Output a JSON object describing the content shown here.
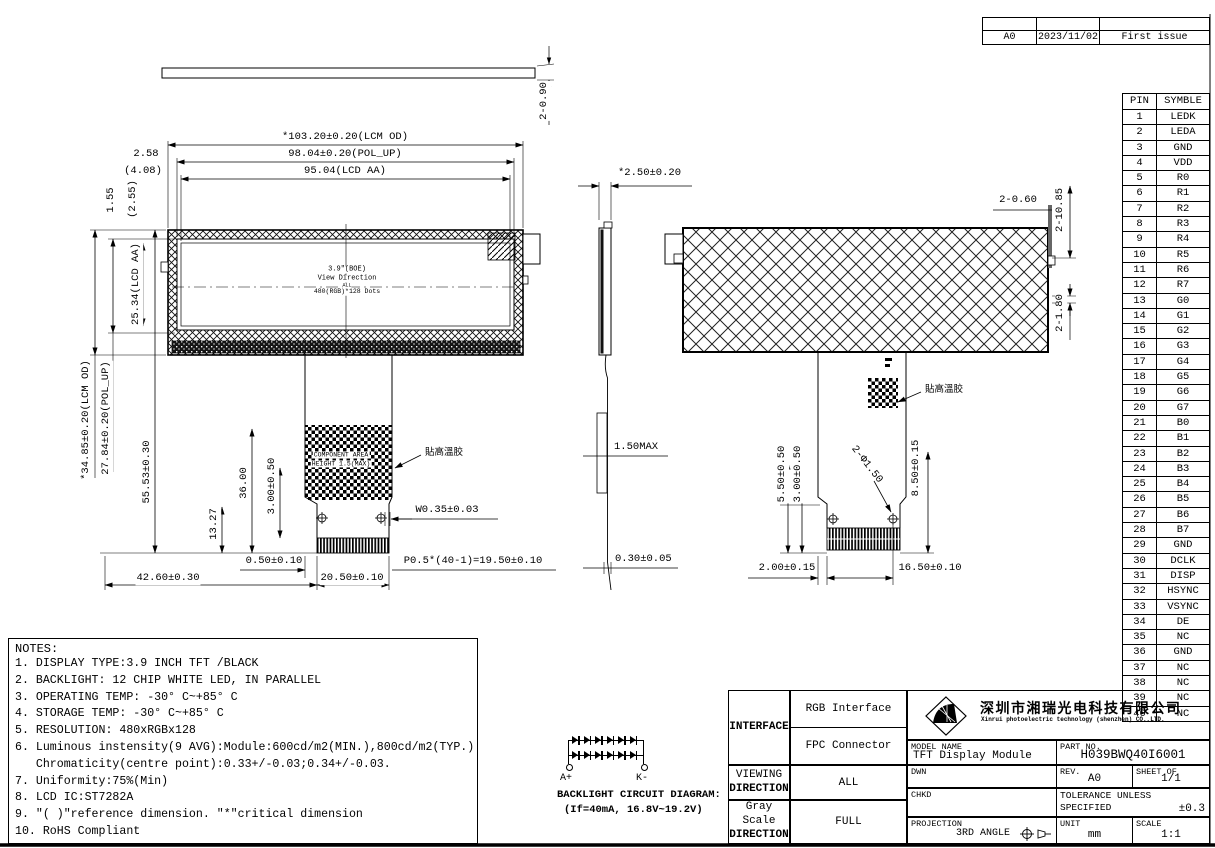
{
  "revision_table": {
    "rev": "A0",
    "date": "2023/11/02",
    "description": "First issue"
  },
  "pin_table": {
    "headers": [
      "PIN",
      "SYMBLE"
    ],
    "rows": [
      [
        "1",
        "LEDK"
      ],
      [
        "2",
        "LEDA"
      ],
      [
        "3",
        "GND"
      ],
      [
        "4",
        "VDD"
      ],
      [
        "5",
        "R0"
      ],
      [
        "6",
        "R1"
      ],
      [
        "7",
        "R2"
      ],
      [
        "8",
        "R3"
      ],
      [
        "9",
        "R4"
      ],
      [
        "10",
        "R5"
      ],
      [
        "11",
        "R6"
      ],
      [
        "12",
        "R7"
      ],
      [
        "13",
        "G0"
      ],
      [
        "14",
        "G1"
      ],
      [
        "15",
        "G2"
      ],
      [
        "16",
        "G3"
      ],
      [
        "17",
        "G4"
      ],
      [
        "18",
        "G5"
      ],
      [
        "19",
        "G6"
      ],
      [
        "20",
        "G7"
      ],
      [
        "21",
        "B0"
      ],
      [
        "22",
        "B1"
      ],
      [
        "23",
        "B2"
      ],
      [
        "24",
        "B3"
      ],
      [
        "25",
        "B4"
      ],
      [
        "26",
        "B5"
      ],
      [
        "27",
        "B6"
      ],
      [
        "28",
        "B7"
      ],
      [
        "29",
        "GND"
      ],
      [
        "30",
        "DCLK"
      ],
      [
        "31",
        "DISP"
      ],
      [
        "32",
        "HSYNC"
      ],
      [
        "33",
        "VSYNC"
      ],
      [
        "34",
        "DE"
      ],
      [
        "35",
        "NC"
      ],
      [
        "36",
        "GND"
      ],
      [
        "37",
        "NC"
      ],
      [
        "38",
        "NC"
      ],
      [
        "39",
        "NC"
      ],
      [
        "40",
        "NC"
      ]
    ]
  },
  "notes": {
    "title": "NOTES:",
    "lines": [
      "1. DISPLAY TYPE:3.9 INCH TFT /BLACK",
      "2. BACKLIGHT: 12 CHIP WHITE LED, IN PARALLEL",
      "3. OPERATING TEMP: -30° C~+85° C",
      "4. STORAGE TEMP: -30° C~+85° C",
      "5. RESOLUTION: 480xRGBx128",
      "6. Luminous instensity(9 AVG):Module:600cd/m2(MIN.),800cd/m2(TYP.)",
      "   Chromaticity(centre point):0.33+/-0.03;0.34+/-0.03.",
      "7. Uniformity:75%(Min)",
      "8. LCD IC:ST7282A",
      "9. ″( )″reference dimension. ″*″critical dimension",
      "10. RoHS Compliant"
    ]
  },
  "dims": {
    "front": {
      "top_thickness": "2-0.90",
      "lcm_od_w": "*103.20±0.20(LCM OD)",
      "pol_w": "98.04±0.20(POL_UP)",
      "aa_w": "95.04(LCD AA)",
      "m258": "2.58",
      "m408": "(4.08)",
      "m155": "1.55",
      "m255": "(2.55)",
      "aa_h": "25.34(LCD AA)",
      "lcm_od_h": "*34.85±0.20(LCM OD)",
      "pol_h": "27.84±0.20(POL_UP)",
      "m5553": "55.53±0.30",
      "m36": "36.00",
      "m300": "3.00±0.50",
      "m1327": "13.27",
      "w035": "W0.35±0.03",
      "m050": "0.50±0.10",
      "m4260": "42.60±0.30",
      "m2050": "20.50±0.10",
      "pitch": "P0.5*(40-1)=19.50±0.10"
    },
    "side": {
      "thickness": "*2.50±0.20",
      "fpc_max": "1.50MAX",
      "fpc_t": "0.30±0.05"
    },
    "back": {
      "b060": "2-0.60",
      "b1085": "2-10.85",
      "b180": "2-1.80",
      "b550": "5.50±0.50",
      "b300": "3.00±0.50",
      "b850": "8.50±0.15",
      "holes": "2-Φ1.50",
      "b200": "2.00±0.15",
      "b1650": "16.50±0.10"
    }
  },
  "screen": {
    "l1": "3.9\"(BOE)",
    "l2": "View Direction",
    "l3": "ALL",
    "l4": "480(RGB)*128 Dots"
  },
  "annotations": {
    "component_area_1": "COMPONENT AREA",
    "component_area_2": "HEIGHT 1.5(MAX)",
    "tape_front": "貼高溫胶",
    "tape_back": "貼高溫胶"
  },
  "backlight": {
    "title": "BACKLIGHT CIRCUIT DIAGRAM:",
    "spec": "(If=40mA,  16.8V~19.2V)",
    "anode": "A+",
    "cathode": "K-",
    "rows": 2,
    "leds_per_row": 6
  },
  "title_block": {
    "interface_label": "INTERFACE",
    "interface_row1": "RGB Interface",
    "interface_row2": "FPC Connector",
    "viewing_line1": "VIEWING",
    "viewing_line2": "DIRECTION",
    "viewing_value": "ALL",
    "gray_line1": "Gray Scale",
    "gray_line2": "DIRECTION",
    "gray_value": "FULL",
    "company_cn": "深圳市湘瑞光电科技有限公司",
    "company_en": "Xinrui photoelectric technology (shenzhen) CO.,LTD.",
    "model_name_label": "MODEL NAME",
    "model_name": "TFT Display Module",
    "part_no_label": "PART NO.",
    "part_no": "H039BWQ40I6001",
    "dwn_label": "DWN",
    "rev_label": "REV.",
    "rev": "A0",
    "sheet_label": "SHEET OF",
    "sheet": "1/1",
    "chkd_label": "CHKD",
    "tol_line1": "TOLERANCE UNLESS",
    "tol_line2": "SPECIFIED",
    "tol_value": "±0.3",
    "proj_label": "PROJECTION",
    "proj_value": "3RD ANGLE",
    "unit_label": "UNIT",
    "unit_value": "mm",
    "scale_label": "SCALE",
    "scale_value": "1:1"
  }
}
